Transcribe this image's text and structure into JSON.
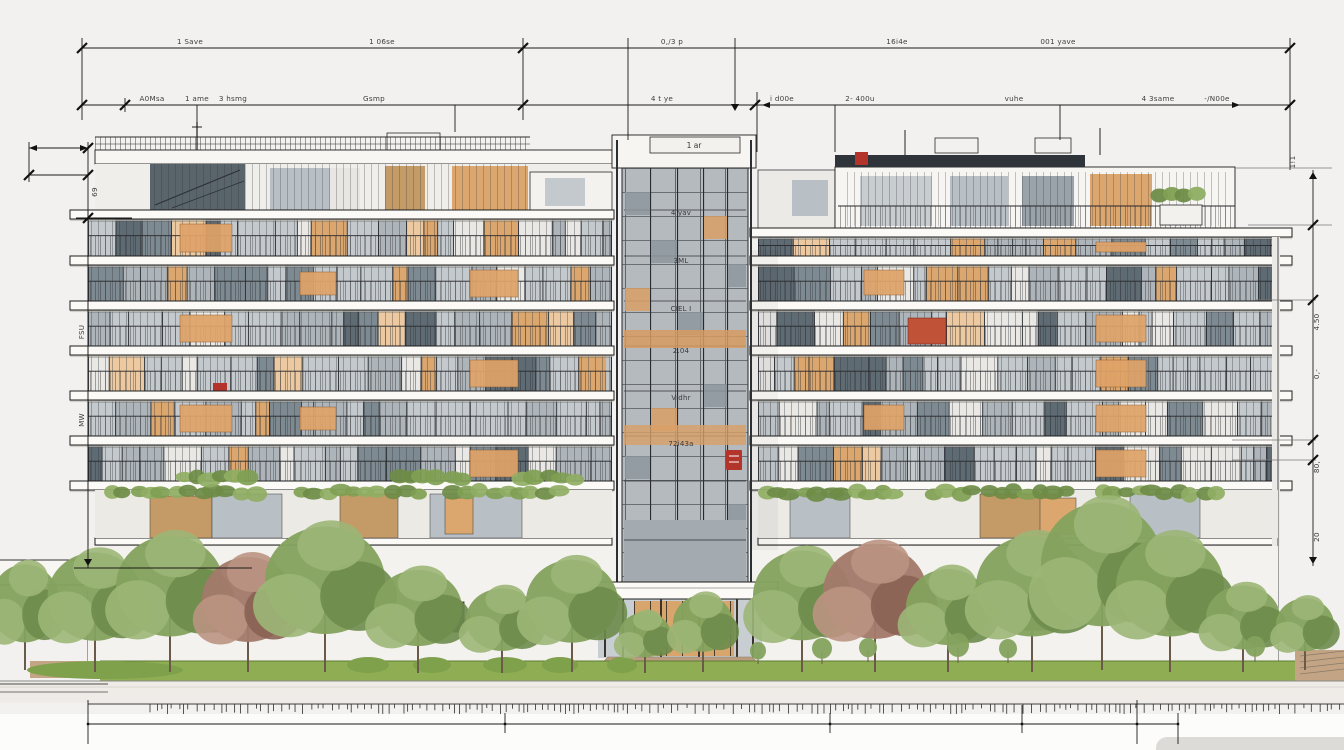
{
  "dims": {
    "row1": [
      "1 Save",
      "1 06se",
      "0,/3 p",
      "16i4e",
      "001 yave"
    ],
    "row2": [
      "A0Msa",
      "1 ame",
      "3 hsmg",
      "Gsmp",
      "4 t ye",
      "i d00e",
      "2- 400u",
      "vuhe",
      "4 3same",
      "-/N00e"
    ],
    "left": {
      "top": "69",
      "mid": "FSU",
      "low": "MW"
    },
    "right": {
      "top": "1!1",
      "r1": "4.50",
      "r2": "0,-",
      "r3": "80,",
      "r4": "20"
    }
  },
  "tower": {
    "box": "1 ar",
    "floors": [
      "4 yav",
      "3ML",
      "CIEL I",
      "2.04",
      "Vidhr",
      "72i43a"
    ]
  },
  "colors": {
    "accent_red": "#b2342a",
    "warm_window": "#dca76e",
    "foliage_green": "#87a562",
    "lawn_green": "#8fae54",
    "glass_gray": "#b9c0c5"
  }
}
